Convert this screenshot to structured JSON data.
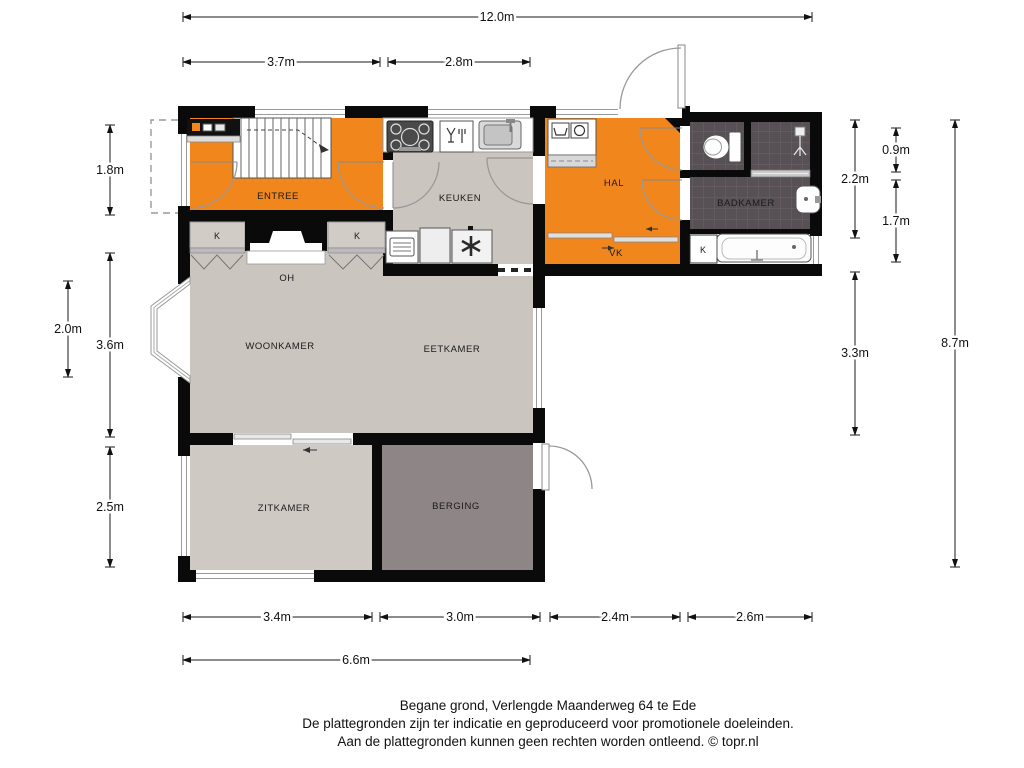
{
  "floorplan": {
    "address_title": "Begane grond, Verlengde Maanderweg 64 te Ede",
    "disclaimer1": "De plattegronden zijn ter indicatie en geproduceerd voor promotionele doeleinden.",
    "disclaimer2": "Aan de plattegronden kunnen geen rechten worden ontleend. © topr.nl",
    "rooms": {
      "entree": "ENTREE",
      "keuken": "KEUKEN",
      "hal": "HAL",
      "vk": "VK",
      "badkamer": "BADKAMER",
      "woonkamer": "WOONKAMER",
      "eetkamer": "EETKAMER",
      "zitkamer": "ZITKAMER",
      "berging": "BERGING",
      "fireplace": "OH",
      "closet_left": "K",
      "closet_right": "K",
      "closet_badkamer": "K"
    },
    "dimensions": {
      "top_total": "12.0m",
      "top_entree": "3.7m",
      "top_keuken": "2.8m",
      "left_entree": "1.8m",
      "left_bay": "2.0m",
      "left_woonkamer": "3.6m",
      "left_zitkamer": "2.5m",
      "right_hal": "2.2m",
      "right_toilet": "0.9m",
      "right_badkamer": "1.7m",
      "right_eetkamer": "3.3m",
      "right_total": "8.7m",
      "bottom_zitkamer": "3.4m",
      "bottom_berging": "3.0m",
      "bottom_hal": "2.4m",
      "bottom_badkamer": "2.6m",
      "bottom_left_total": "6.6m"
    },
    "colors": {
      "accent_orange": "#F0861C",
      "floor_gray": "#CBC5C0",
      "zitkamer_gray": "#CFC9C4",
      "berging_gray": "#8E8587",
      "tile_dark": "#575054",
      "closet_gray": "#D2CCC7",
      "wall_black": "#0A0A0A"
    },
    "icons": {
      "stove": "gas-hob-icon",
      "dishwasher": "dishwasher-icon",
      "sink": "sink-icon",
      "oven": "oven-icon",
      "fridge": "fridge-icon",
      "freezer": "freezer-icon",
      "washer": "washing-machine-icon",
      "toilet": "toilet-icon",
      "shower": "shower-icon",
      "bathtub": "bathtub-icon",
      "washbasin": "washbasin-icon",
      "meter_cupboard": "meter-cupboard-icon",
      "stairs": "stairs-icon"
    }
  }
}
